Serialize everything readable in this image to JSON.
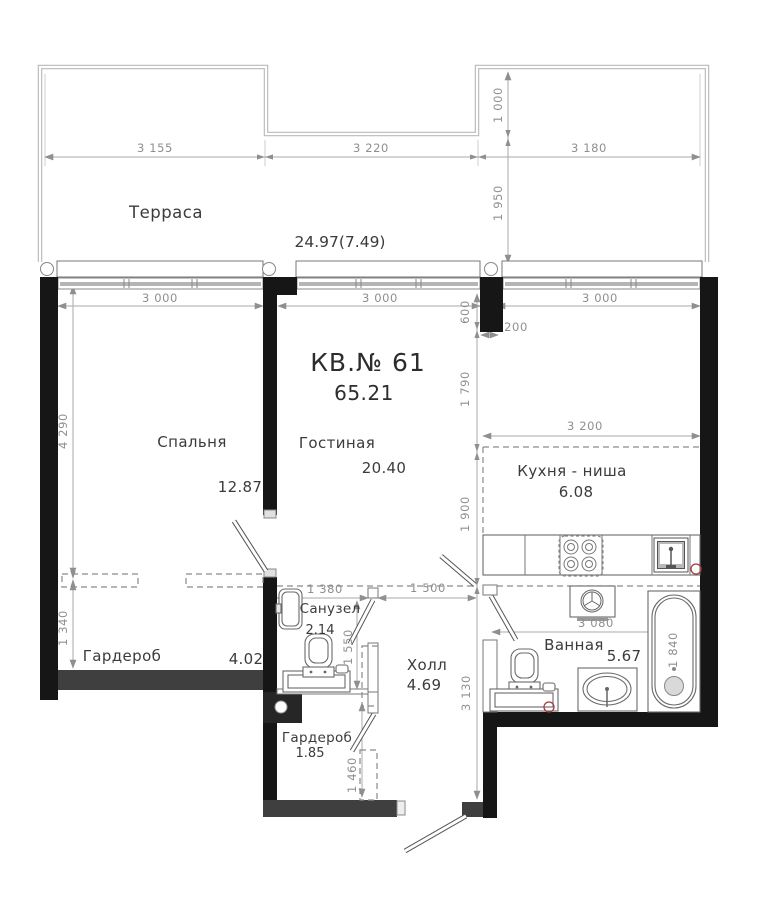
{
  "header": {
    "apartment_label": "КВ.№ 61",
    "total_area": "65.21"
  },
  "rooms": {
    "terrace": {
      "name": "Терраса",
      "area": "24.97(7.49)"
    },
    "bedroom": {
      "name": "Спальня",
      "area": "12.87"
    },
    "living": {
      "name": "Гостиная",
      "area": "20.40"
    },
    "kitchen": {
      "name": "Кухня - ниша",
      "area": "6.08"
    },
    "wc": {
      "name": "Санузел",
      "area": "2.14"
    },
    "hall": {
      "name": "Холл",
      "area": "4.69"
    },
    "bathroom": {
      "name": "Ванная",
      "area": "5.67"
    },
    "wardrobe_big": {
      "name": "Гардероб",
      "area": "4.02"
    },
    "wardrobe_small": {
      "name": "Гардероб",
      "area": "1.85"
    }
  },
  "dimensions": {
    "top_3155": "3 155",
    "top_3220": "3 220",
    "top_3180": "3 180",
    "terr_1000": "1 000",
    "terr_1950": "1 950",
    "win_3000_a": "3 000",
    "win_3000_b": "3 000",
    "win_3000_c": "3 000",
    "v600": "600",
    "h200": "200",
    "v1790": "1 790",
    "v1900": "1 900",
    "k3200": "3 200",
    "left_4290": "4 290",
    "left_1340": "1 340",
    "wc_1380": "1 380",
    "hall_1500": "1 500",
    "wc_1550": "1 550",
    "hall_3130": "3 130",
    "ward_1460": "1 460",
    "bath_3080": "3 080",
    "tub_1840": "1 840"
  },
  "colors": {
    "wall": "#161616",
    "wall_gray": "#3f3f3f",
    "dim": "#8f8f8f",
    "accent_red": "#a33d3d"
  }
}
